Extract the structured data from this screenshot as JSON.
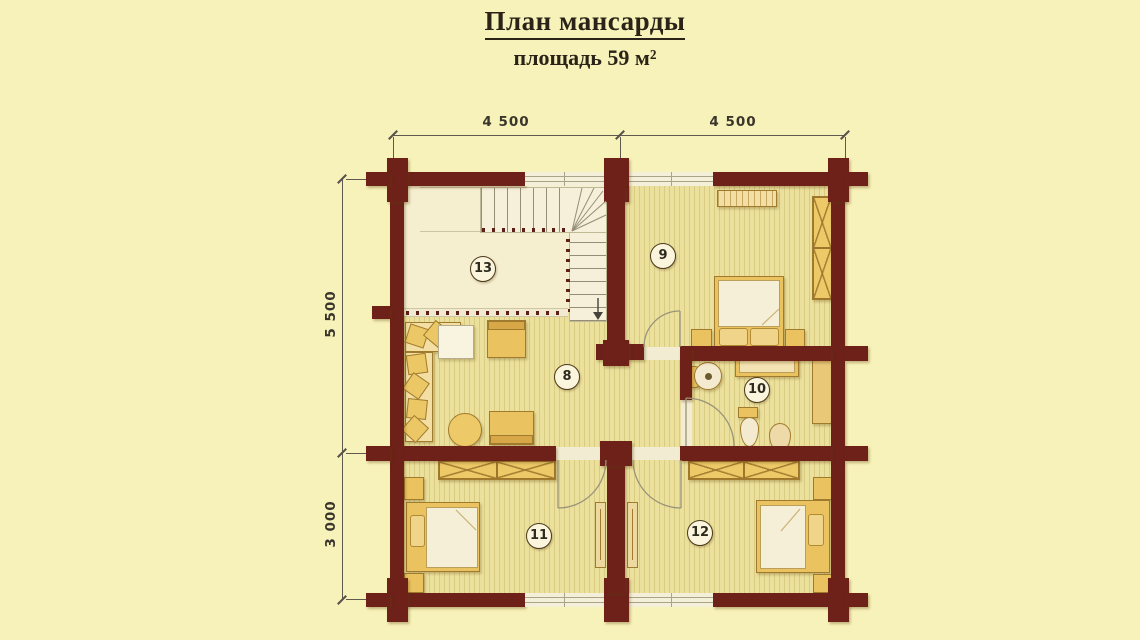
{
  "title": {
    "heading": "План мансарды",
    "subtitle": "площадь  59 м²"
  },
  "dims": {
    "top": [
      "4 500",
      "4 500"
    ],
    "left": [
      "5 500",
      "3 000"
    ]
  },
  "rooms": [
    {
      "label": "13"
    },
    {
      "label": "8"
    },
    {
      "label": "9"
    },
    {
      "label": "10"
    },
    {
      "label": "11"
    },
    {
      "label": "12"
    }
  ],
  "colors": {
    "bg": "#f7f2b9",
    "wall": "#6d2119",
    "floor": "#ebe19d",
    "floor_stripe": "#d9cc82",
    "hall_floor": "#f5eecf",
    "furniture": "#eac25f",
    "furniture_border": "#a07b2e",
    "mattress": "#f6efd7",
    "dot": "#5d1f16",
    "dim_text": "#3b362c"
  }
}
